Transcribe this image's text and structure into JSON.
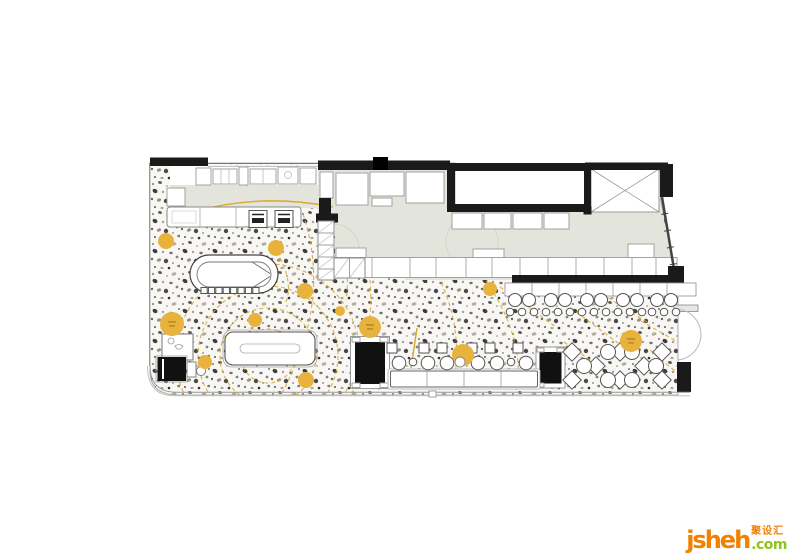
{
  "watermark": {
    "brand": "jsheh",
    "brand_cn": "聚设汇",
    "tld": ".com",
    "orange": "#F08200",
    "green": "#8FC31F"
  },
  "plan": {
    "type": "restaurant-floor-plan",
    "colors": {
      "wall": "#1A1A1A",
      "kitchen": "#E3E4DC",
      "floor_base": "#F8F7F4",
      "gold": "#E8B33C",
      "gold_line": "#D9A82F",
      "furniture_outline": "#555555"
    },
    "accent_circles": [
      {
        "x": 166,
        "y": 241,
        "r": 8
      },
      {
        "x": 276,
        "y": 248,
        "r": 8
      },
      {
        "x": 305,
        "y": 291,
        "r": 8
      },
      {
        "x": 172,
        "y": 324,
        "r": 12,
        "labeled": true
      },
      {
        "x": 255,
        "y": 320,
        "r": 7
      },
      {
        "x": 205,
        "y": 362,
        "r": 7
      },
      {
        "x": 340,
        "y": 311,
        "r": 5
      },
      {
        "x": 370,
        "y": 327,
        "r": 11,
        "labeled": true
      },
      {
        "x": 306,
        "y": 380,
        "r": 8
      },
      {
        "x": 463,
        "y": 355,
        "r": 11
      },
      {
        "x": 490,
        "y": 289,
        "r": 7
      },
      {
        "x": 631,
        "y": 341,
        "r": 11,
        "labeled": true
      }
    ],
    "bar_stools": {
      "y_big": 300,
      "y_small": 312,
      "r_big": 6.5,
      "r_small": 3.8,
      "cluster_x": [
        515,
        551,
        587,
        623,
        657
      ],
      "big_dx": [
        0,
        14
      ],
      "small_dx": [
        -5,
        7,
        19
      ]
    },
    "banquette_row": {
      "chair_y": 343,
      "chair_size": 10,
      "chair_x": [
        392,
        424,
        442,
        472,
        490,
        518
      ],
      "table_y": 363,
      "table_r": 6.8,
      "table_x": [
        399,
        428,
        447,
        478,
        497,
        526
      ],
      "small_y": 362,
      "small_r": 3.8,
      "small_x": [
        413,
        462,
        511
      ]
    },
    "diamond_dining": {
      "size": 13,
      "round_r": 7.5,
      "diamonds": [
        [
          572,
          352
        ],
        [
          596,
          366
        ],
        [
          572,
          380
        ],
        [
          620,
          352
        ],
        [
          644,
          366
        ],
        [
          620,
          380
        ],
        [
          662,
          352
        ],
        [
          662,
          380
        ]
      ],
      "rounds": [
        [
          584,
          366
        ],
        [
          608,
          352
        ],
        [
          608,
          380
        ],
        [
          632,
          352
        ],
        [
          632,
          380
        ],
        [
          656,
          366
        ]
      ]
    },
    "oval_bar_stools": {
      "x0": 201,
      "step": 7.4,
      "n": 8,
      "y": 287.5,
      "w": 6.2,
      "h": 6
    }
  }
}
